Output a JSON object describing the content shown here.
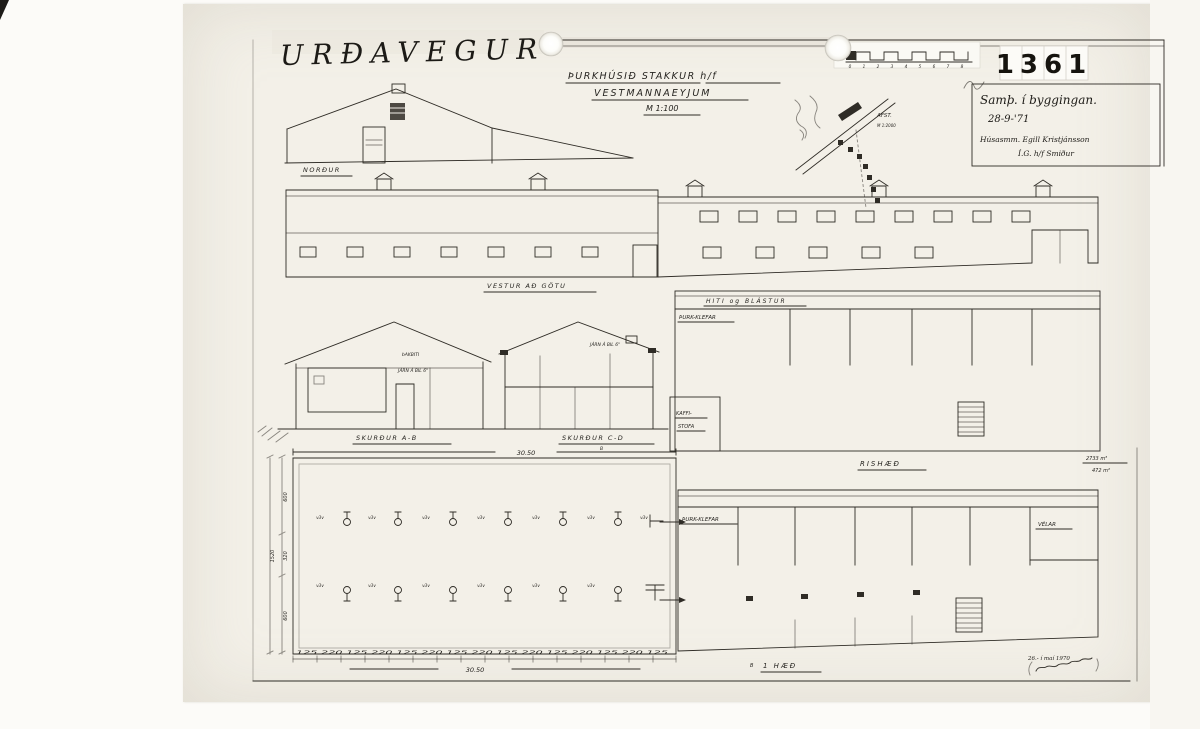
{
  "colors": {
    "paper": "#f3f0e8",
    "ink": "#2f2c26"
  },
  "header": {
    "street_name": "URÐAVEGUR",
    "archive_number": "1361"
  },
  "title_block": {
    "project": "ÞURKHÚSIÐ STAKKUR h/f",
    "location": "VESTMANNAEYJUM",
    "scale": "M 1:100"
  },
  "approval_stamp": {
    "line1": "Samþ. í byggingan.",
    "date": "28-9-'71",
    "line3": "Húsasmm. Egill Kristjánsson",
    "line4": "Í.G. h/f Smiður"
  },
  "scale_bar": {
    "ticks": [
      "0",
      "1",
      "2",
      "3",
      "4",
      "5",
      "6",
      "7",
      "8"
    ]
  },
  "site_map": {
    "title": "AFST.",
    "scale": "M 1:2000"
  },
  "labels": {
    "north_elevation": "NORÐUR",
    "west_elevation": "VESTUR AÐ GÖTU",
    "section_ab": "SKURÐUR A-B",
    "section_cd": "SKURÐUR C-D",
    "attic_plan": "RISHÆÐ",
    "ground_plan": "1 HÆÐ",
    "marker_b": "B"
  },
  "annotations": {
    "roof_beam": "ÞAKBITI",
    "iron_spacing": "JÁRN Á BIL 6\"",
    "heat_band": "HITI og BLÁSTUR",
    "drying_rooms": "ÞURK-KLEFAR",
    "coffee_line1": "KAFFI-",
    "coffee_line2": "STOFA",
    "machine_room": "VÉLAR",
    "volume": "2733 m³",
    "area": "472 m²",
    "date_note": "26.- í maí 1970"
  },
  "dimensions": {
    "top_width": "30.50",
    "bottom_width": "30.50",
    "bottom_chain": "125 220 125 220 125 220 125 220 125 220 125 220 125 220 125",
    "left_heights": [
      "600",
      "320",
      "600"
    ],
    "left_total": "1520",
    "column_mark": "v3v"
  }
}
